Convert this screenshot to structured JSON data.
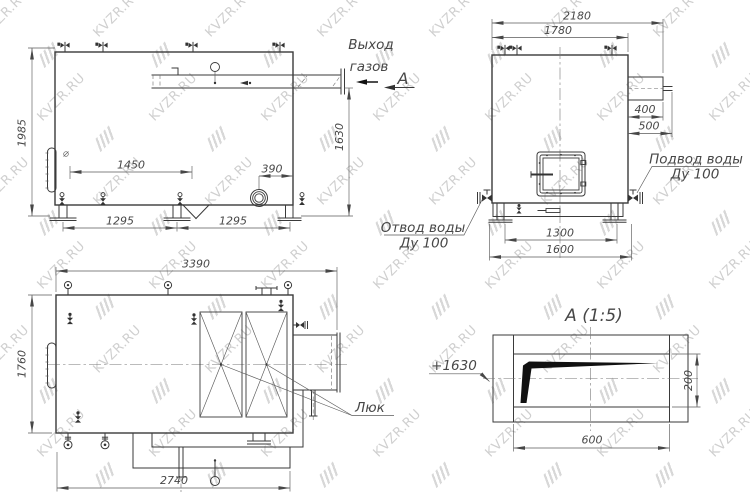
{
  "watermark": {
    "text": "KVZR.RU"
  },
  "side_view": {
    "dim_height": "1985",
    "dim_valve_spacing": "1450",
    "dim_flange_offset": "390",
    "dim_outlet_height": "1630",
    "dim_leg_span_left": "1295",
    "dim_leg_span_right": "1295",
    "label_gas_outlet_line1": "Выход",
    "label_gas_outlet_line2": "газов",
    "label_view_arrow": "А"
  },
  "end_view": {
    "dim_overall_width": "2180",
    "dim_body_width": "1780",
    "dim_duct_length": "400",
    "dim_duct_total": "500",
    "dim_leg_span": "1300",
    "dim_base_width": "1600",
    "label_water_inlet_line1": "Подвод воды",
    "label_water_inlet_line2": "Ду 100",
    "label_water_outlet_line1": "Отвод воды",
    "label_water_outlet_line2": "Ду 100"
  },
  "plan_view": {
    "dim_length_overall": "3390",
    "dim_width_overall": "1760",
    "dim_base_length": "2740",
    "label_hatch": "Люк"
  },
  "detail_view": {
    "title": "А (1:5)",
    "dim_width": "600",
    "dim_height": "200",
    "label_elevation": "+1630"
  }
}
